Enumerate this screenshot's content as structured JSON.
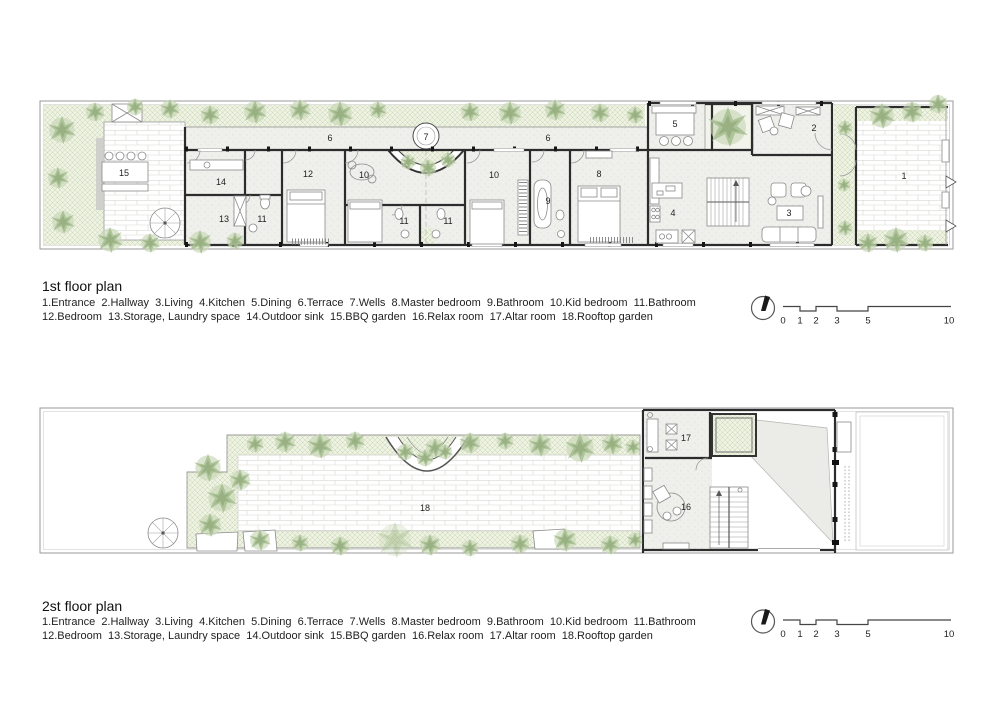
{
  "plan1": {
    "title": "1st floor plan",
    "room_labels": [
      "15",
      "14",
      "13",
      "11",
      "12",
      "6",
      "7",
      "6",
      "10",
      "10",
      "11",
      "11",
      "9",
      "8",
      "5",
      "2",
      "4",
      "3",
      "1"
    ]
  },
  "plan2": {
    "title": "2st floor plan",
    "room_labels": [
      "18",
      "17",
      "16"
    ]
  },
  "legend": {
    "line1": "1.Entrance  2.Hallway  3.Living  4.Kitchen  5.Dining  6.Terrace  7.Wells  8.Master bedroom  9.Bathroom  10.Kid bedroom  11.Bathroom",
    "line2": "12.Bedroom  13.Storage, Laundry space  14.Outdoor sink  15.BBQ garden  16.Relax room  17.Altar room  18.Rooftop garden"
  },
  "scalebar": {
    "ticks": [
      "0",
      "1",
      "2",
      "3",
      "5",
      "10"
    ]
  },
  "icons": {
    "north_arrow": "north-arrow-icon",
    "spiral_stair": "spiral-stair-icon"
  },
  "colors": {
    "foliage": "#a9c093",
    "foliage_dark": "#93ad7c",
    "foliage_pale": "#c8d6b6",
    "hatch_line": "#c9d6b4",
    "hatch_bg": "#eef2e2",
    "wall": "#2c2c2c",
    "brick_line": "#d7d7d1",
    "floor_speckle": "#efefec"
  }
}
